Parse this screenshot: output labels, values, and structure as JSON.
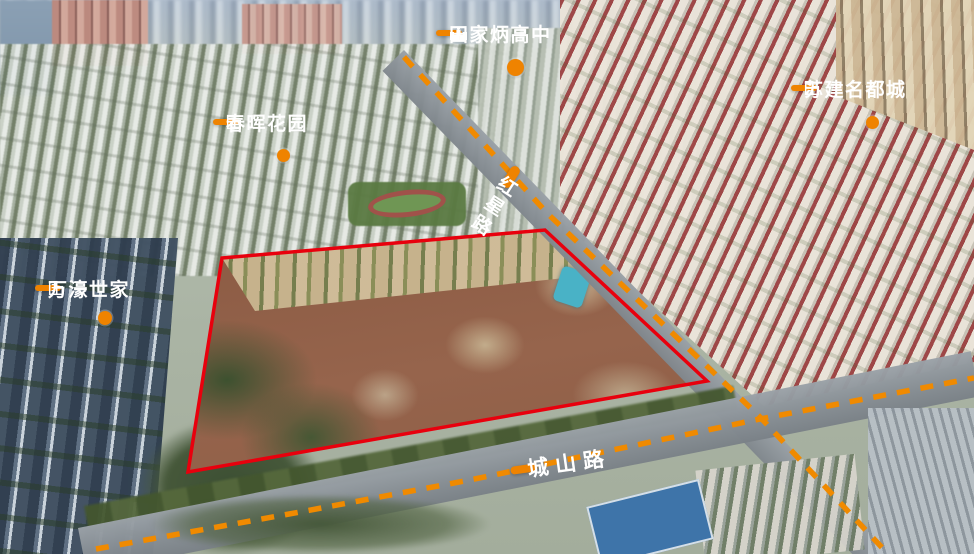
{
  "map": {
    "poi_labels": [
      {
        "id": "tianjiabing-school",
        "text": "田家炳高中",
        "icon": "school-icon"
      },
      {
        "id": "chunhui-garden",
        "text": "春晖花园",
        "icon": "building-icon"
      },
      {
        "id": "sujian-mingducheng",
        "text": "苏建名都城",
        "icon": "building-icon"
      },
      {
        "id": "wanhao-shijia",
        "text": "万濠世家",
        "icon": "building-icon"
      }
    ],
    "road_labels": [
      {
        "id": "hongxing-road",
        "text": "红星路",
        "orientation": "vertical"
      },
      {
        "id": "chengshan-road",
        "text": "城山路",
        "orientation": "horizontal"
      }
    ],
    "boundary": {
      "type": "land-parcel-outline",
      "color": "#E8000D"
    },
    "colors": {
      "label_orange": "#EF8300",
      "road_dash_orange": "#F08A00",
      "boundary_red": "#E8000D"
    }
  }
}
